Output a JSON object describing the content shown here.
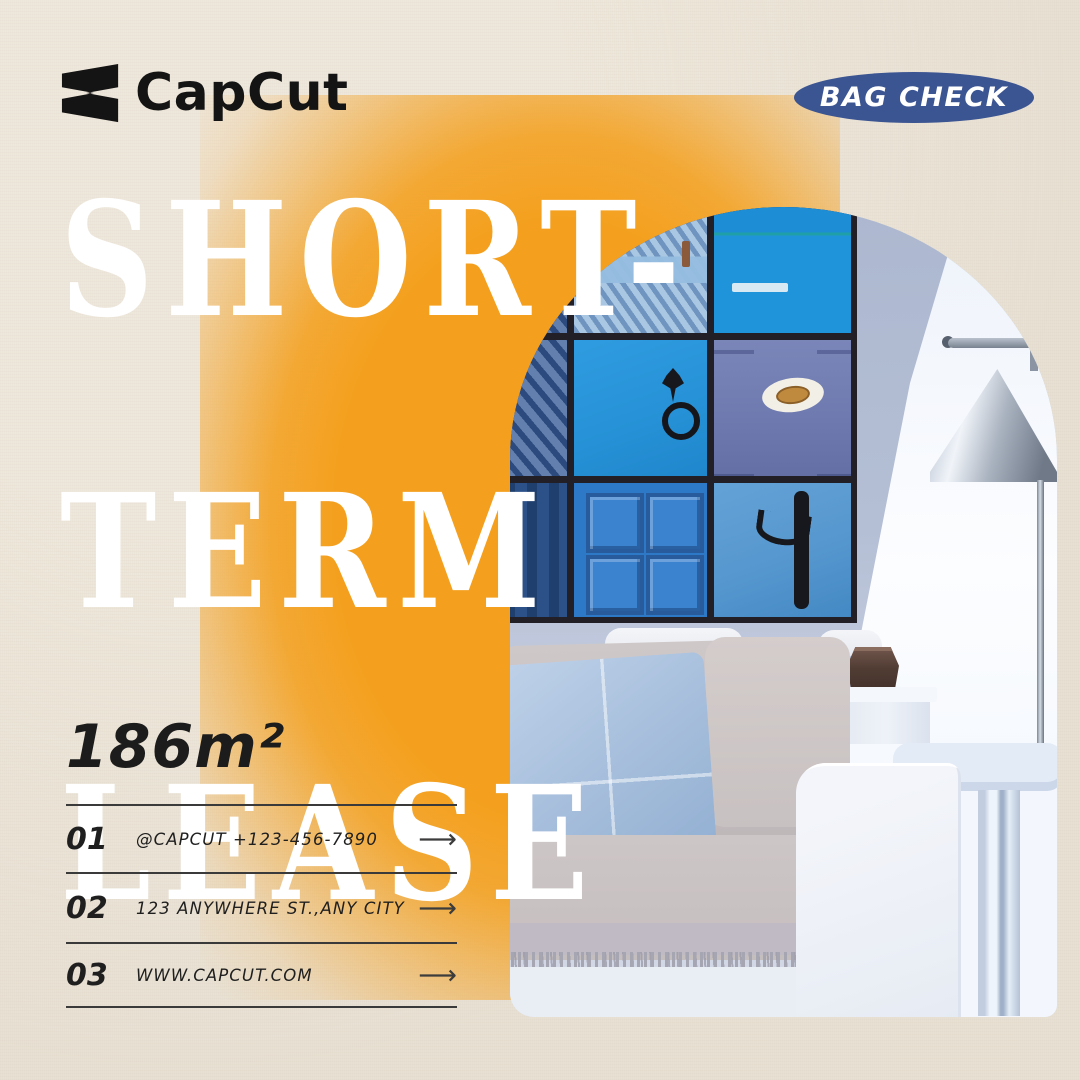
{
  "brand": {
    "name": "CapCut"
  },
  "badge": {
    "label": "BAG CHECK",
    "bg_color": "#3b5492",
    "text_color": "#ffffff"
  },
  "headline": {
    "line1": "SHORT-",
    "line2": "TERM",
    "line3": "LEASE",
    "color": "#ffffff"
  },
  "area": {
    "value": "186m²"
  },
  "contact_rows": [
    {
      "number": "01",
      "text": "@CAPCUT  +123-456-7890",
      "arrow": "⟶"
    },
    {
      "number": "02",
      "text": "123 ANYWHERE ST.,ANY CITY",
      "arrow": "⟶"
    },
    {
      "number": "03",
      "text": "WWW.CAPCUT.COM",
      "arrow": "⟶"
    }
  ],
  "colors": {
    "background_beige": "#e8e1d2",
    "accent_orange": "#f4a01e",
    "badge_blue": "#3b5492",
    "text_dark": "#1c1c1c",
    "headline_white": "#ffffff"
  }
}
